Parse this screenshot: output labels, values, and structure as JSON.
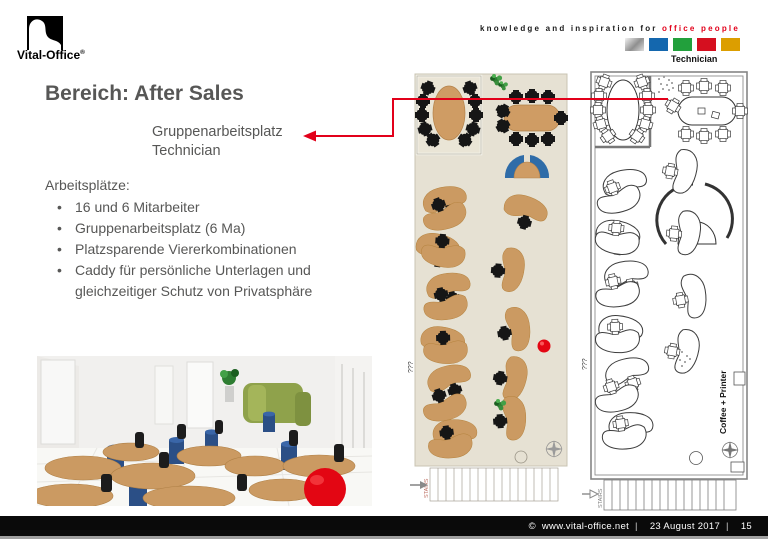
{
  "logo": {
    "brand": "Vital-Office",
    "registered": "®"
  },
  "header": {
    "tagline_black": "knowledge and inspiration for",
    "tagline_red": "office people",
    "plan_label": "Technician",
    "palette_squares": [
      {
        "name": "silver",
        "color": "#b5b5b5"
      },
      {
        "name": "blue",
        "color": "#1467ae"
      },
      {
        "name": "green",
        "color": "#22a03c"
      },
      {
        "name": "red",
        "color": "#d50f1f"
      },
      {
        "name": "gold",
        "color": "#dc9e00"
      }
    ]
  },
  "content": {
    "title": "Bereich: After Sales",
    "callout_line1": "Gruppenarbeitsplatz",
    "callout_line2": "Technician",
    "list_heading": "Arbeitsplätze:",
    "bullet_char": "•",
    "bullets": [
      "16 und 6 Mitarbeiter",
      "Gruppenarbeitsplatz (6 Ma)",
      "Platzsparende Viererkombinationen",
      "Caddy für persönliche Unterlagen und gleichzeitiger Schutz von Privatsphäre"
    ]
  },
  "floor_plans": {
    "colored": {
      "labels": {
        "unknown": "???",
        "stairs": "STAIRS"
      }
    },
    "outline": {
      "labels": {
        "unknown": "???",
        "stairs": "STAIRS",
        "coffee_printer": "Coffee + Printer"
      }
    }
  },
  "footer": {
    "copyright": "©",
    "site": "www.vital-office.net",
    "separator": "|",
    "date": "23 August 2017",
    "page_number": "15"
  },
  "colors": {
    "accent_red": "#e2001a",
    "text_gray": "#575756",
    "plan_background": "#e6e1d3",
    "desk_tan": "#cb9a62",
    "chair_black": "#161616",
    "caddy_blue": "#2b4f86",
    "partition_green": "#8fa24b",
    "ball_red": "#e30613"
  }
}
